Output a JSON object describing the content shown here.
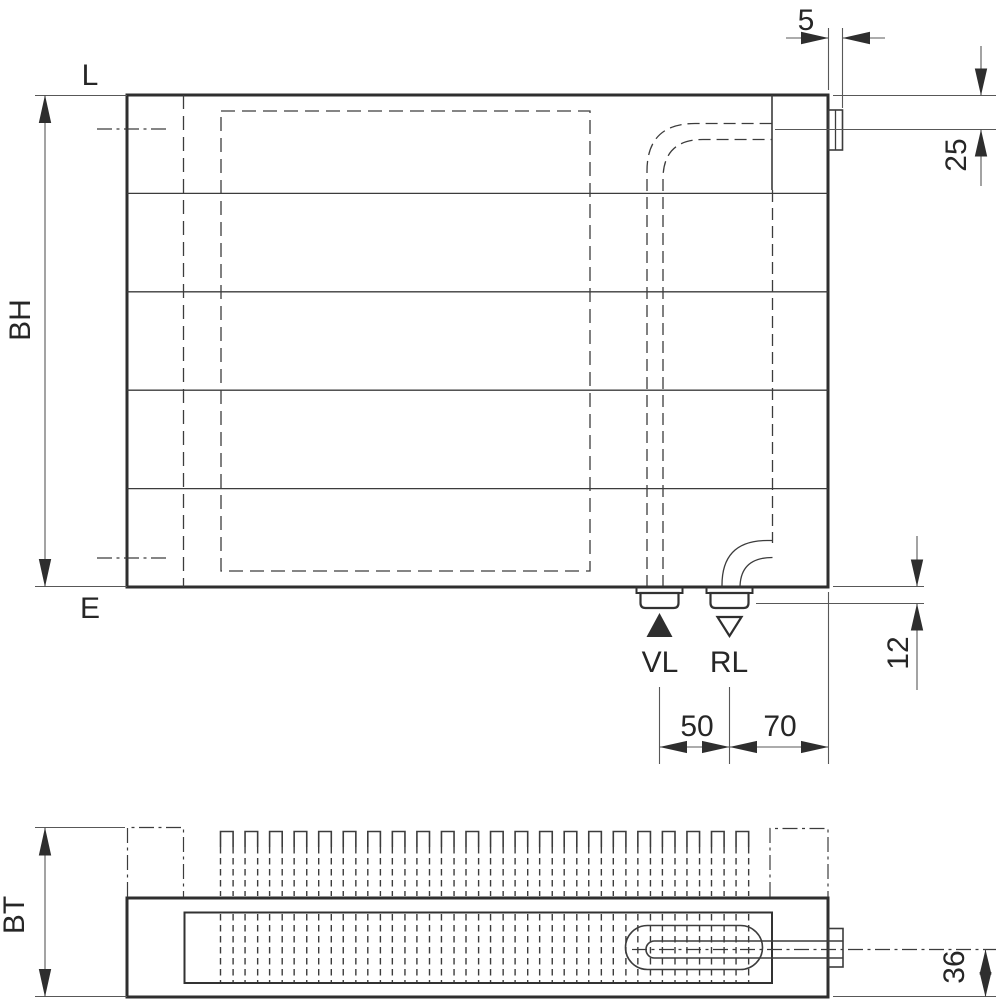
{
  "drawing": {
    "description": "Radiator technical drawing, front view and top view with connection dimensions",
    "colors": {
      "background": "#ffffff",
      "lines": "#3c3c3c",
      "heavy_lines": "#2e2e2e",
      "text": "#262626"
    },
    "front_view": {
      "length_label": "L",
      "height_label": "BH",
      "bottom_label": "E",
      "supply_label": "VL",
      "return_label": "RL",
      "dim_bracket_width": "5",
      "dim_top_to_axis": "25",
      "dim_bottom_to_stub_face": "12",
      "dim_supply_return_spacing": "50",
      "dim_return_to_edge": "70"
    },
    "top_view": {
      "depth_label": "BT",
      "dim_axis_to_face": "36"
    }
  }
}
